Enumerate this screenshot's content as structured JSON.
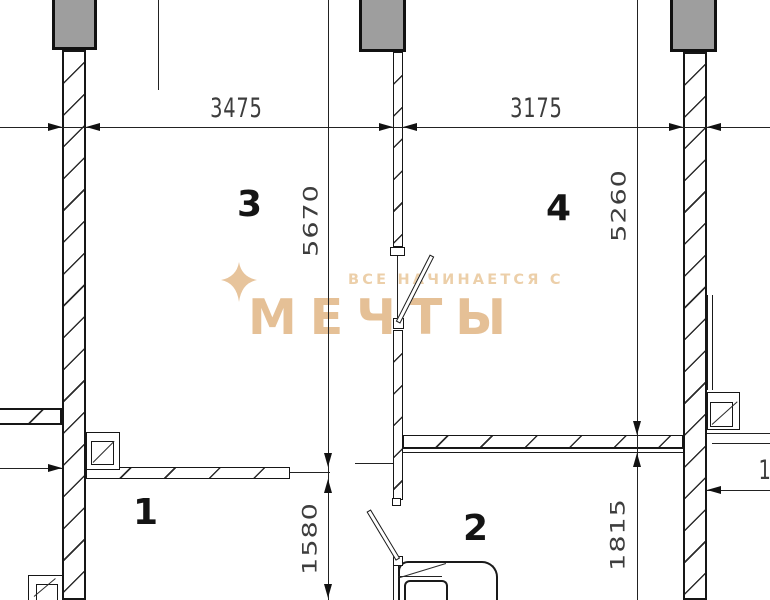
{
  "watermark": {
    "subtitle": "ВСЕ НАЧИНАЕТСЯ С",
    "title": "МЕЧТЫ"
  },
  "dimensions": {
    "span_left": "3475",
    "span_right": "3175",
    "height_left": "5670",
    "height_right": "5260",
    "lower_left": "1580",
    "lower_right": "1815",
    "edge_partial": "1"
  },
  "rooms": [
    {
      "number": "3"
    },
    {
      "number": "4"
    },
    {
      "number": "1"
    },
    {
      "number": "2"
    }
  ],
  "colors": {
    "column_fill": "#9e9e9e",
    "line": "#1a1a1a",
    "dim_text": "#3d3d3d",
    "watermark_title": "#e5c096",
    "watermark_subtitle": "#eccfa9"
  }
}
